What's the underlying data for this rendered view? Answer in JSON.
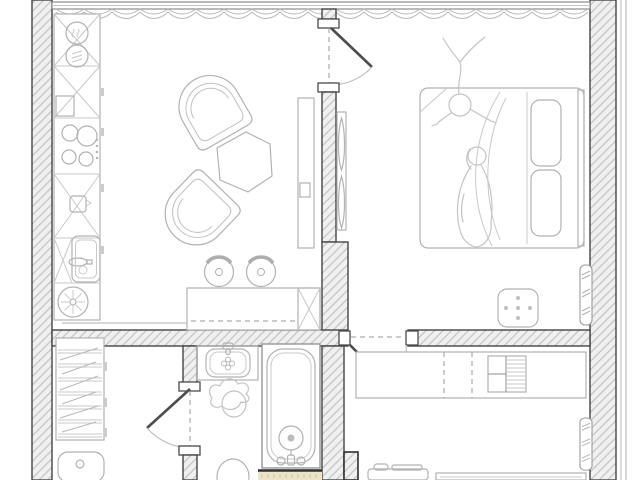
{
  "title": "one-bedroom-apartment-floor-plan",
  "canvas": {
    "width": 640,
    "height": 480
  },
  "palette": {
    "background": "#ffffff",
    "wall_fill": "#f0f0f0",
    "wall_hatch": "#c2c2c2",
    "wall_outline": "#454545",
    "furniture_line": "#b2b2b2",
    "sketch_line": "#c4c4c4",
    "floor_mat": "#ece4c9"
  },
  "rooms": [
    {
      "name": "kitchen-living-room",
      "position": "top-left",
      "furniture": [
        "stacked-washer-dryer",
        "kitchen-cabinet-run",
        "cooktop",
        "kitchen-sink",
        "extractor-hob-fan",
        "armchair-upper",
        "armchair-lower",
        "hexagonal-coffee-table",
        "tv-console",
        "bar-counter",
        "bar-stool-left",
        "bar-stool-right"
      ]
    },
    {
      "name": "bedroom",
      "position": "top-right",
      "furniture": [
        "double-bed",
        "pillow-top",
        "pillow-bottom",
        "blanket-folds",
        "sketched-child-figure",
        "sketched-adult-figure",
        "ottoman-pouf",
        "wall-wardrobe-strip",
        "radiator"
      ]
    },
    {
      "name": "dressing-room",
      "position": "bottom-left",
      "furniture": [
        "shelving-wardrobe",
        "laundry-basket"
      ]
    },
    {
      "name": "bathroom",
      "position": "bottom-center",
      "furniture": [
        "vanity-counter",
        "washbasin",
        "sketched-figure",
        "toilet",
        "bathtub",
        "tub-drain",
        "tub-faucet",
        "floor-mat"
      ]
    },
    {
      "name": "hallway",
      "position": "bottom-right",
      "furniture": [
        "built-in-wardrobe",
        "shelf-module",
        "shoe-cabinet",
        "entry-bench",
        "radiator"
      ]
    }
  ],
  "openings": {
    "window": "full-width-top-window-with-curtain",
    "doors": [
      "living-to-bedroom-door",
      "bedroom-to-hallway-door",
      "dressing-to-bathroom-door"
    ]
  }
}
